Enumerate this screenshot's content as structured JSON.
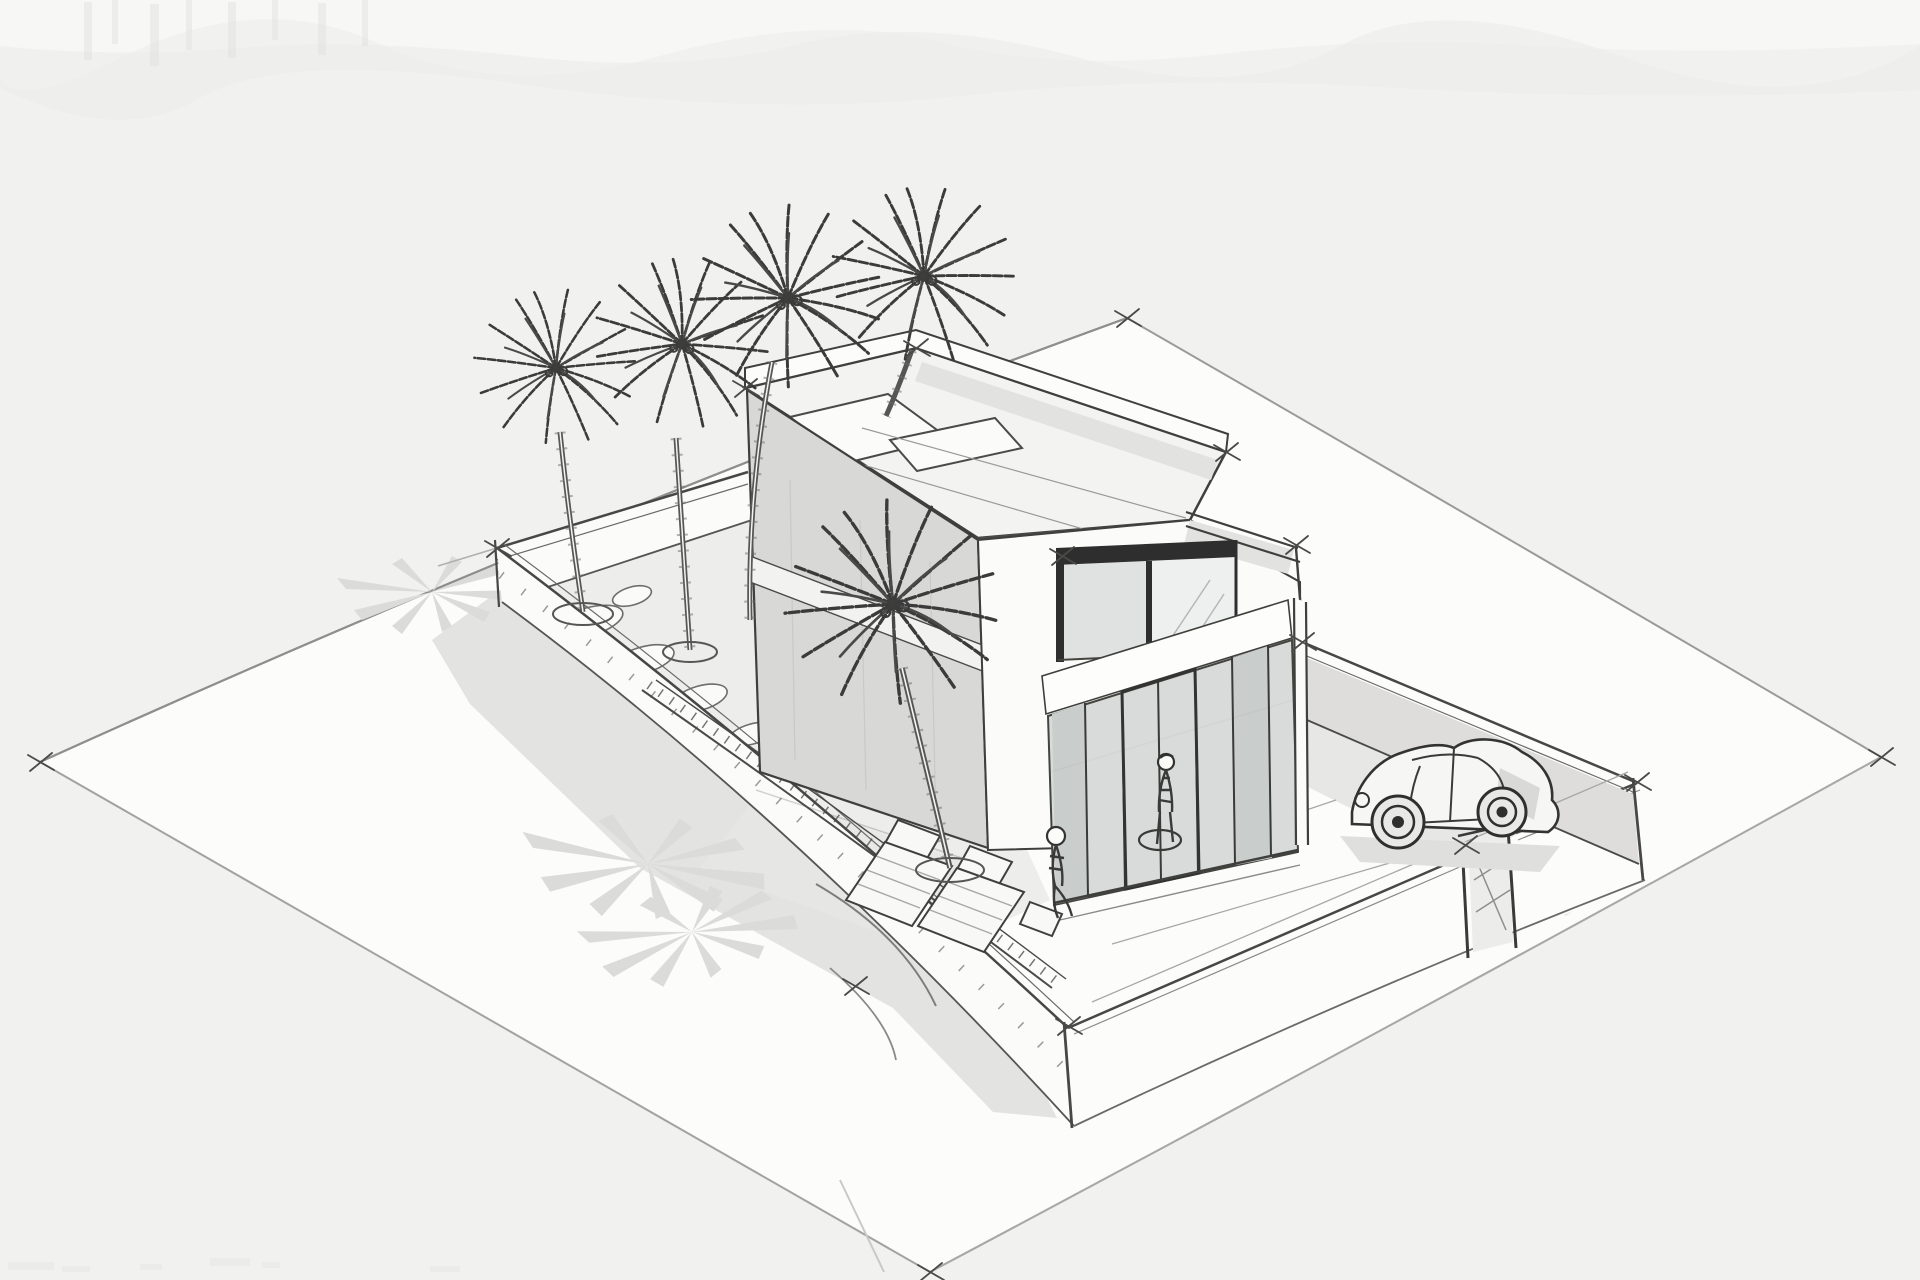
{
  "scene": {
    "type": "architectural-concept-sketch",
    "medium": "freehand ink and marker on textured watercolor paper",
    "view": "aerial three-quarter perspective",
    "subject": "Modern flat-roof two-storey villa on a walled corner plot with palms, driveway and car",
    "counts": {
      "palm_trees": 5,
      "people": 2,
      "cars": 1,
      "sun_loungers": 2,
      "roof_skylights": 2,
      "gates": 1,
      "palm_shadow_patches": 3
    },
    "palette": {
      "paper": "#f1f1ef",
      "paper_top_wash": "#f6f6f4",
      "plot_white": "#fcfcfb",
      "ink": "#3d3d3b",
      "wall_white": "#fbfbfa",
      "facade_gray": "#d8d8d7",
      "glass_gray": "#d8dbda",
      "window_frame": "#2e2e2e",
      "shadow_gray": "#e3e3e1",
      "palm_shadow_gray": "#dbdbd9"
    },
    "labels": {
      "root": "Hand-drawn architectural perspective sketch of a modern villa",
      "paper": "watercolor paper background with torn-edge wash at top",
      "plot": "large corner plot ground plane",
      "shadows": "soft cast shadows of building, walls and palms",
      "arcs": "curved construction strokes at plot front",
      "walls": "low perimeter garden walls with corner posts",
      "gate": "pedestrian gate in the front-right wall",
      "garden": "palm garden bed with stepping stones and planters",
      "terrace": "terrace edging and paving joint lines",
      "house": "two-storey flat-roof villa volume",
      "roof": "flat roof slab with parapet and skylights",
      "side_facade": "shaded south-west end facade",
      "slab_band": "white floor-slab band on side facade",
      "window": "dark-framed first-floor window",
      "beam": "slab beam above entrance",
      "entrance": "double-height glazed entrance with mullions",
      "corner_post": "white ground-floor corner post",
      "balcony": "first-floor balcony rail and deck",
      "car": "beetle-style car parked in the driveway",
      "person_standing": "standing figure at the entrance",
      "person_seated": "seated figure beside the loungers",
      "furniture": "two sun loungers and a side table",
      "palms": "five sketched palm trees",
      "ticks": "sketchy corner tick marks",
      "bottom_marks": "faint smudge marks at sheet bottom edge"
    }
  }
}
